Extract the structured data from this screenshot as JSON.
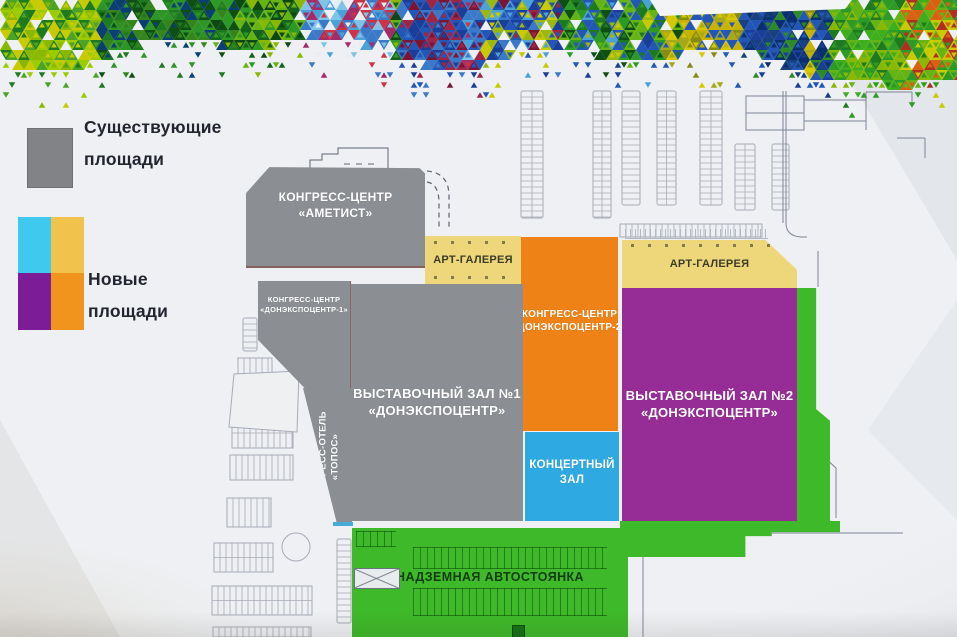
{
  "legend": {
    "existing": {
      "l1": "Существующие",
      "l2": "площади"
    },
    "new": {
      "l1": "Новые",
      "l2": "площади"
    }
  },
  "buildings": {
    "ametist": {
      "l1": "КОНГРЕСС-ЦЕНТР",
      "l2": "«АМЕТИСТ»"
    },
    "art_gallery_left": {
      "label": "АРТ-ГАЛЕРЕЯ"
    },
    "art_gallery_right": {
      "label": "АРТ-ГАЛЕРЕЯ"
    },
    "don1": {
      "l1": "КОНГРЕСС-ЦЕНТР",
      "l2": "«ДОНЭКСПОЦЕНТР-1»"
    },
    "don2": {
      "l1": "КОНГРЕСС-ЦЕНТР",
      "l2": "«ДОНЭКСПОЦЕНТР-2»"
    },
    "hall1": {
      "l1": "ВЫСТАВОЧНЫЙ ЗАЛ №1",
      "l2": "«ДОНЭКСПОЦЕНТР»"
    },
    "hall2": {
      "l1": "ВЫСТАВОЧНЫЙ ЗАЛ №2",
      "l2": "«ДОНЭКСПОЦЕНТР»"
    },
    "topos": {
      "l1": "КОНГРЕСС-ОТЕЛЬ",
      "l2": "«ТОПОС»"
    },
    "concert": {
      "l1": "КОНЦЕРТНЫЙ",
      "l2": "ЗАЛ"
    },
    "parking_deck": {
      "label": "НАДЗЕМНАЯ АВТОСТОЯНКА"
    }
  },
  "colors": {
    "existing_gray": "#8b8e92",
    "legend_gray": "#818387",
    "new_cyan": "#2fa9e2",
    "new_yellow": "#eed77b",
    "new_purple": "#962d96",
    "new_orange": "#ee8217",
    "new_green": "#3eb929",
    "legend_cyan": "#3fc9ef",
    "legend_yellow": "#f2c34c",
    "legend_purple": "#7c1d97",
    "legend_orange": "#f0941d"
  }
}
